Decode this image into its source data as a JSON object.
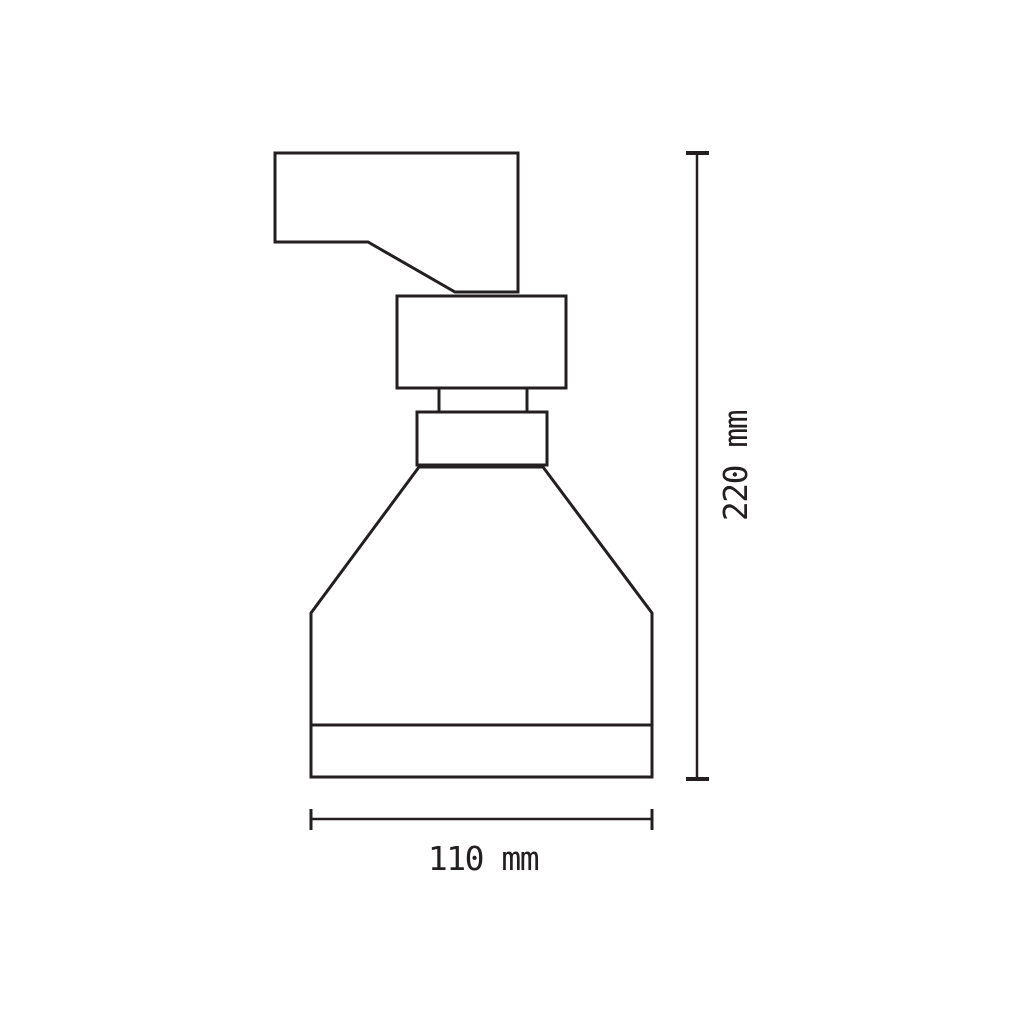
{
  "colors": {
    "line": "#231f20",
    "bg": "#ffffff"
  },
  "drawing": {
    "subject": "trigger-spray-bottle-front-view"
  },
  "dimensions": {
    "height": {
      "label": "220 mm",
      "value": "220",
      "unit": "mm",
      "orientation": "vertical"
    },
    "width": {
      "label": "110 mm",
      "value": "110",
      "unit": "mm",
      "orientation": "horizontal"
    }
  }
}
